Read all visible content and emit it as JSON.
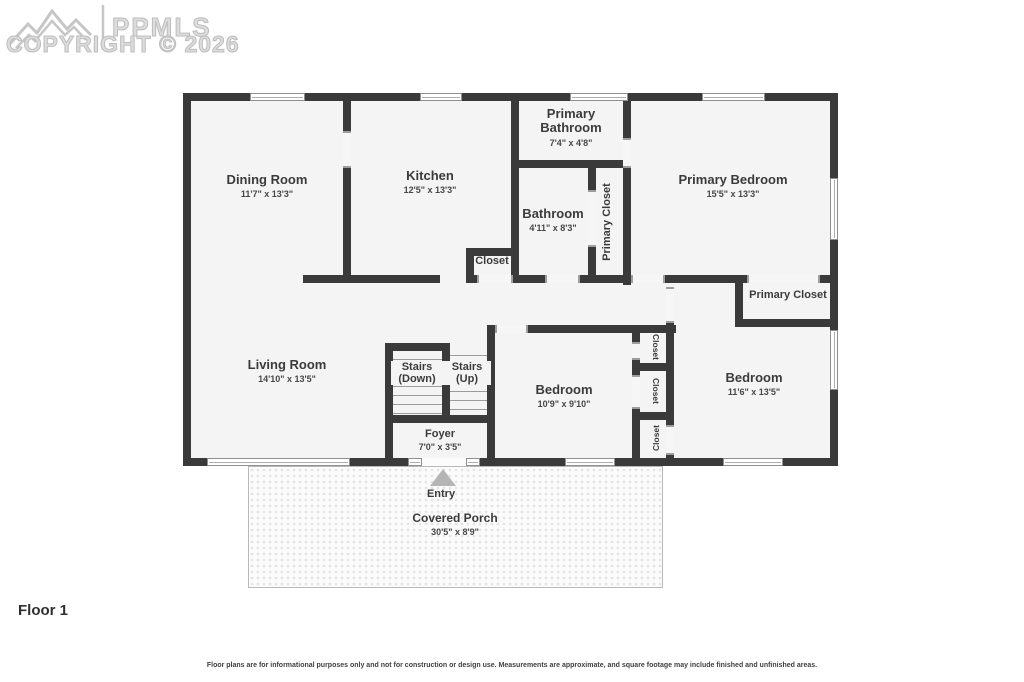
{
  "watermark": {
    "brand": "PPMLS",
    "copyright": "COPYRIGHT © 2026"
  },
  "floor_title": "Floor 1",
  "disclaimer": "Floor plans are for informational purposes only and not for construction or design use. Measurements are approximate, and square footage may include finished and unfinished areas.",
  "colors": {
    "wall": "#3a3a3a",
    "floor": "#f4f4f4",
    "label_text": "#3b3b3b",
    "watermark": "#c8c8c8",
    "entry_arrow": "#b5b5b5"
  },
  "rooms": {
    "dining": {
      "label": "Dining Room",
      "dims": "11'7\" x 13'3\""
    },
    "kitchen": {
      "label": "Kitchen",
      "dims": "12'5\" x 13'3\""
    },
    "primary_bathroom": {
      "label": "Primary Bathroom",
      "dims": "7'4\" x 4'8\""
    },
    "bathroom": {
      "label": "Bathroom",
      "dims": "4'11\" x 8'3\""
    },
    "kitchen_closet": {
      "label": "Closet"
    },
    "primary_closet_tall": {
      "label": "Primary Closet"
    },
    "primary_bedroom": {
      "label": "Primary Bedroom",
      "dims": "15'5\" x 13'3\""
    },
    "primary_closet_room": {
      "label": "Primary Closet"
    },
    "living": {
      "label": "Living Room",
      "dims": "14'10\" x 13'5\""
    },
    "stairs_down": {
      "label": "Stairs (Down)"
    },
    "stairs_up": {
      "label": "Stairs (Up)"
    },
    "foyer": {
      "label": "Foyer",
      "dims": "7'0\" x 3'5\""
    },
    "bedroom_mid": {
      "label": "Bedroom",
      "dims": "10'9\" x 9'10\""
    },
    "bedroom_right": {
      "label": "Bedroom",
      "dims": "11'6\" x 13'5\""
    },
    "closet1": {
      "label": "Closet"
    },
    "closet2": {
      "label": "Closet"
    },
    "closet3": {
      "label": "Closet"
    },
    "entry": {
      "label": "Entry"
    },
    "porch": {
      "label": "Covered Porch",
      "dims": "30'5\" x 8'9\""
    }
  }
}
